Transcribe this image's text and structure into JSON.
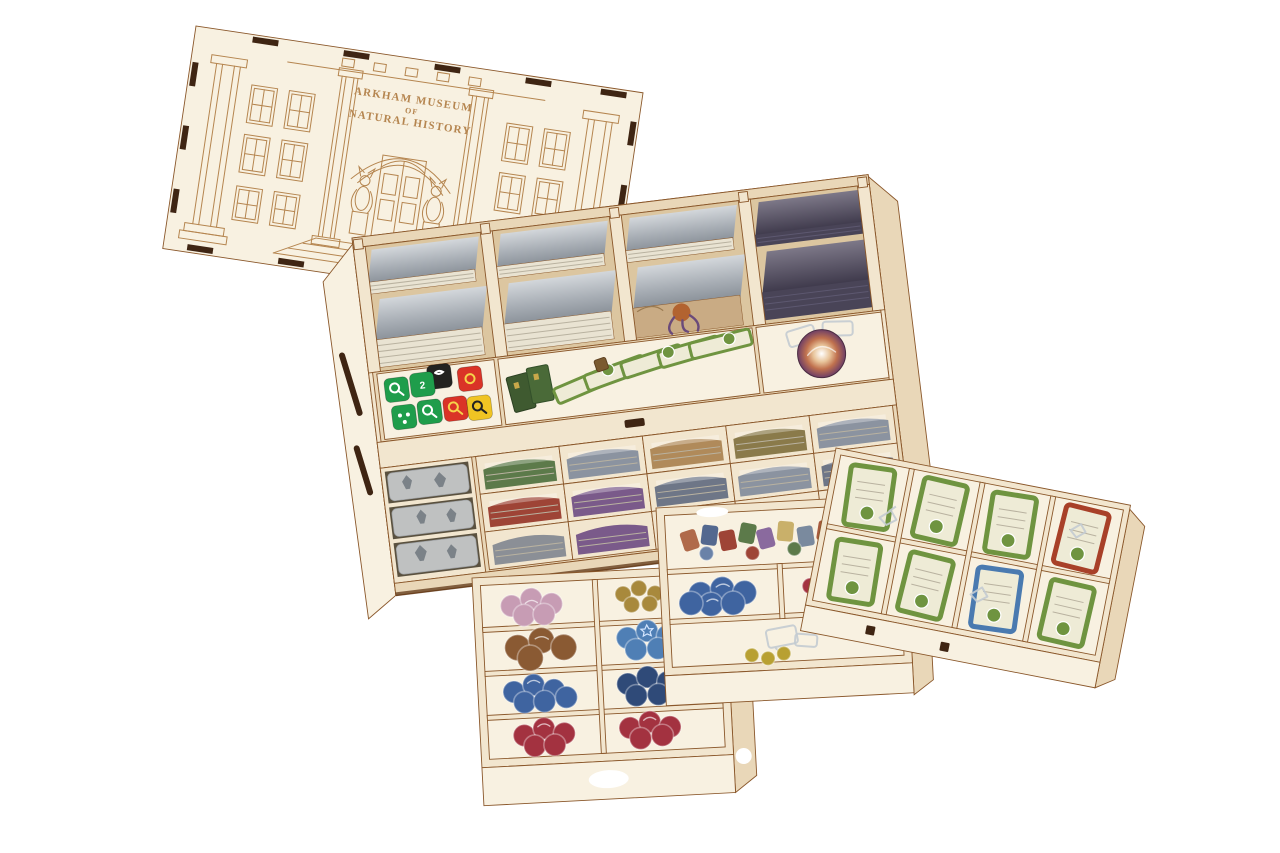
{
  "scene": {
    "kind": "product photograph",
    "subject": "laser-cut wooden board game box organizer insert with engraved lid, card bays, dice, tokens and three removable trays",
    "background": "#ffffff"
  },
  "lid": {
    "engraving_line1": "ARKHAM MUSEUM",
    "engraving_line2": "OF",
    "engraving_line3": "NATURAL HISTORY"
  },
  "dice": {
    "visible_face_number": "2",
    "colors": [
      "green",
      "black",
      "red",
      "yellow"
    ]
  },
  "trays": {
    "left": [
      "pink tokens",
      "gold tokens",
      "brown tokens",
      "blue star tokens",
      "blue tokens",
      "navy tokens",
      "red tokens",
      "red tokens"
    ],
    "middle": [
      "portrait tokens",
      "blue tokens",
      "red and teal tokens",
      "clear plastic clip",
      "yellow tokens"
    ],
    "right": [
      "green barricade tiles",
      "red tile",
      "blue tile",
      "clear plastic clips"
    ]
  },
  "colors": {
    "wood": "#f2e6cf",
    "wood_light": "#f8f1e1",
    "wood_mid": "#e9d7b8",
    "wood_dark": "#dcc6a0",
    "edge": "#8a572a",
    "edge_dark": "#5d3516",
    "engrave": "#b5854f",
    "tab": "#3f2513",
    "card_face": "#e9e3d2",
    "card_line": "#b9b2a0",
    "die_green": "#1f9d4b",
    "die_black": "#232320",
    "die_red": "#da3327",
    "die_yellow": "#f0c423",
    "tile_green": "#6f9440",
    "tile_cream": "#eeebd6",
    "tile_red": "#a84028",
    "tile_blue": "#4a7ab0",
    "tok_pink": "#c79cb4",
    "tok_gold": "#a8893c",
    "tok_brown": "#8a5a33",
    "tok_blue_star": "#4f7fb5",
    "tok_blue": "#3f64a0",
    "tok_navy": "#2f4a78",
    "tok_red": "#a33240",
    "tok_teal": "#3a8f8f",
    "tok_yellow": "#b8a032",
    "mini_bag": "#cdd1d4",
    "plastic": "#c3cbd2",
    "art_tan": "#c9ab84",
    "art_octopus": "#b26330"
  }
}
